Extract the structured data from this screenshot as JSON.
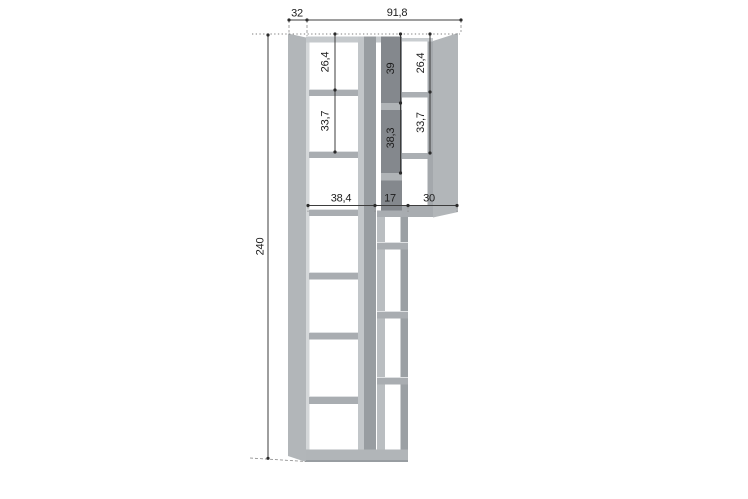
{
  "drawing": {
    "colors": {
      "panel": "#b2b6b9",
      "panel_light": "#c5c9cc",
      "panel_dark": "#84888d",
      "shelf": "#a9adb1",
      "line": "#3d3d3d"
    },
    "dims": {
      "depth": "32",
      "width": "91,8",
      "height": "240",
      "left_col": {
        "top_cell": "26,4",
        "second_cell": "33,7"
      },
      "center_col": {
        "top_cell": "39",
        "second_cell": "38,3"
      },
      "right_col": {
        "top_cell": "26,4",
        "second_cell": "33,7"
      },
      "widths": {
        "left": "38,4",
        "center": "17",
        "right": "30"
      }
    }
  }
}
